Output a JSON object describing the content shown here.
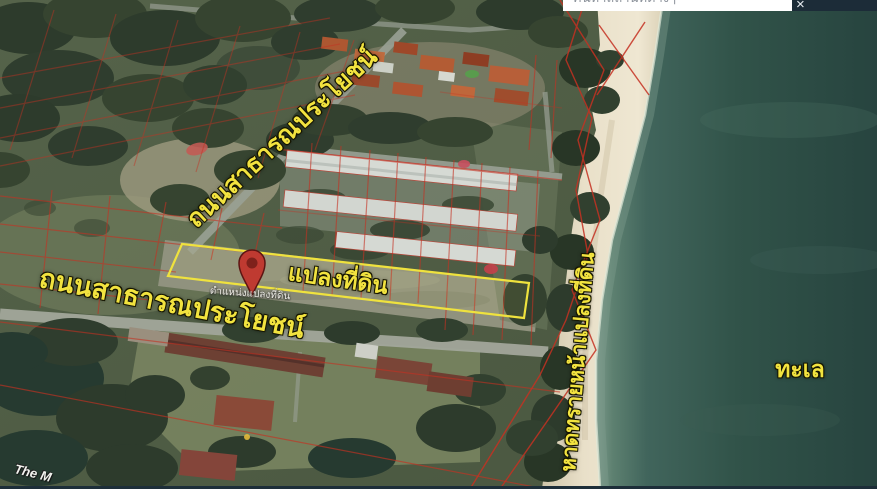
{
  "topbar": {
    "search_placeholder": "ค้นหาสถานที่ต่างๆ",
    "close_glyph": "×"
  },
  "map_labels": {
    "road_diagonal": "ถนนสาธารณประโยชน์",
    "road_horizontal": "ถนนสาธารณประโยชน์",
    "plot": "แปลงที่ดิน",
    "pin_caption": "ตำแหน่งแปลงที่ดิน",
    "beach": "หาดทรายหน้าแปลงที่ดิน",
    "sea": "ทะเล",
    "partial_place_name": "The M"
  },
  "icons": {
    "close": "close-icon",
    "projects": "projects-icon",
    "globe": "globe-icon",
    "pin": "location-pin-icon"
  },
  "colors": {
    "label_yellow": "#f2e33f",
    "plot_outline_yellow": "#efe23e",
    "cadastral_red": "#c53122",
    "pin_red": "#bf3a31",
    "sea_teal": "#2e4f48",
    "sand": "#e9e0c9",
    "ui_navy": "#1c2c38"
  }
}
